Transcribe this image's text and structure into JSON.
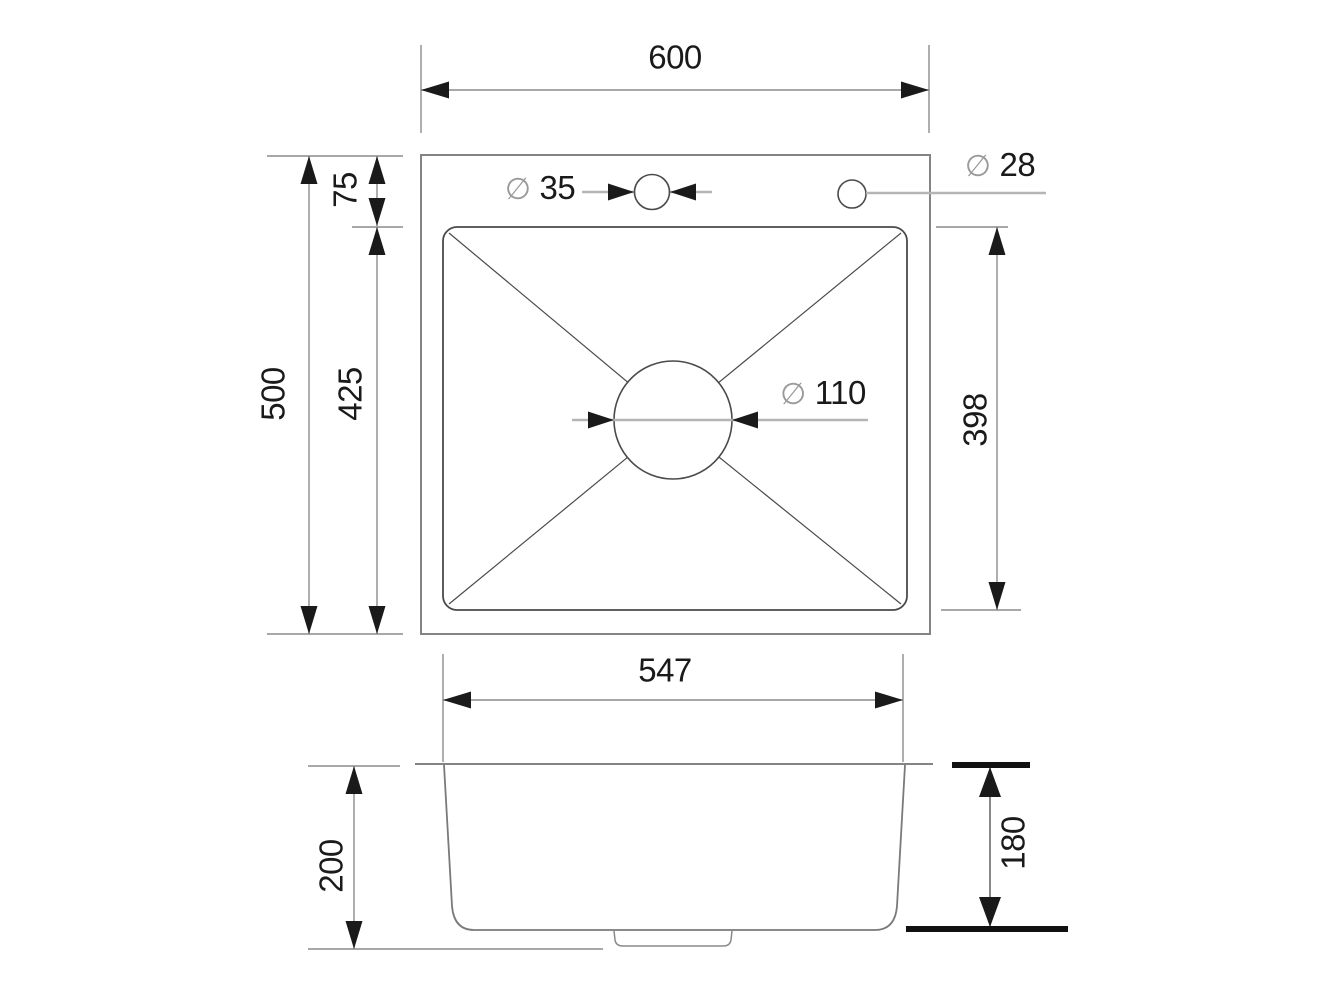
{
  "symbols": {
    "diameter": "∅"
  },
  "views": {
    "top": {
      "width_label": "600",
      "height_label": "500",
      "rim_offset_label": "75",
      "bowl_height_left_label": "425",
      "bowl_height_right_label": "398",
      "faucet_hole_label": "35",
      "accessory_hole_label": "28",
      "drain_label": "110"
    },
    "side": {
      "bowl_width_label": "547",
      "outer_depth_label": "200",
      "inner_depth_label": "180"
    }
  },
  "colors": {
    "background": "#ffffff",
    "outline_main": "#848484",
    "outline_detail": "#4a4a4a",
    "dimension_line": "#8c8c8c",
    "leader_line": "#b5b5b5",
    "ink": "#1a1a1a",
    "diameter_symbol": "#9a9a9a"
  }
}
